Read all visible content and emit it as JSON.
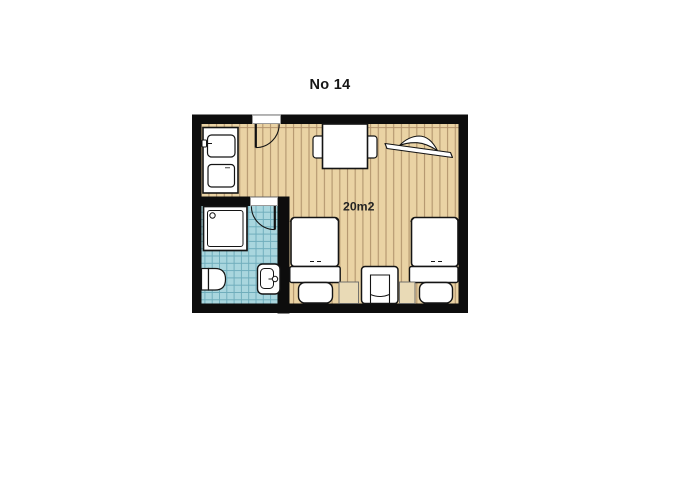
{
  "title": "No 14",
  "plan": {
    "area_label": "20m2",
    "rooms": [
      {
        "name": "bedroom",
        "floor": "wood plank"
      },
      {
        "name": "bathroom",
        "floor": "blue tile"
      }
    ],
    "furniture": {
      "kitchenette_unit": 1,
      "dining_table": 1,
      "dining_chairs": 2,
      "wall_shelf": 1,
      "beds": 2,
      "armchair": 1,
      "nightstands": 2,
      "shower": 1,
      "toilet": 1,
      "sink": 1,
      "doors": [
        "entry-door",
        "bathroom-door"
      ]
    },
    "colors": {
      "wall": "#0d0d0d",
      "wood_floor": "#ead3a4",
      "wood_stripe": "#ab8d66",
      "tile_floor": "#a9d6de",
      "tile_line": "#6fadbc",
      "furniture": "#ffffff",
      "outline": "#141414",
      "nightstand": "#e9dab6",
      "text": "#161616"
    }
  }
}
